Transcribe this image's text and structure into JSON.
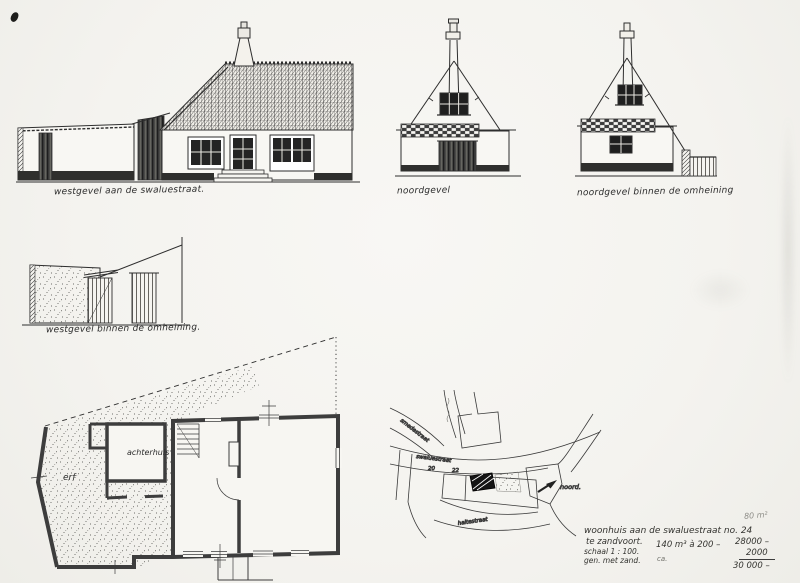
{
  "colors": {
    "ink": "#2e2e2e",
    "paper": "#f4f3ef"
  },
  "elevations": {
    "west_street": {
      "label": "westgevel aan de swaluestraat."
    },
    "north": {
      "label": "noordgevel"
    },
    "north_inside": {
      "label": "noordgevel binnen de omheining"
    },
    "west_inside": {
      "label": "westgevel binnen de omheining."
    }
  },
  "plan": {
    "achterhuis": "achterhuis",
    "erf": "erf"
  },
  "map": {
    "smedestraat": "smedestraat",
    "swaluestraat": "swaluestraat",
    "haltestraat": "haltestraat",
    "no20": "20",
    "no22": "22",
    "noord": "noord."
  },
  "title_block": {
    "area_note": "80 m²",
    "title": "woonhuis aan de swaluestraat no. 24",
    "place": "te zandvoort.",
    "scale": "schaal 1 : 100.",
    "note": "gen. met zand.",
    "calc_volume": "140 m³ à 200 –",
    "calc_approx": "ca.",
    "sum_line1": "28000 –",
    "sum_line2": "2000",
    "sum_total": "30 000 –"
  }
}
